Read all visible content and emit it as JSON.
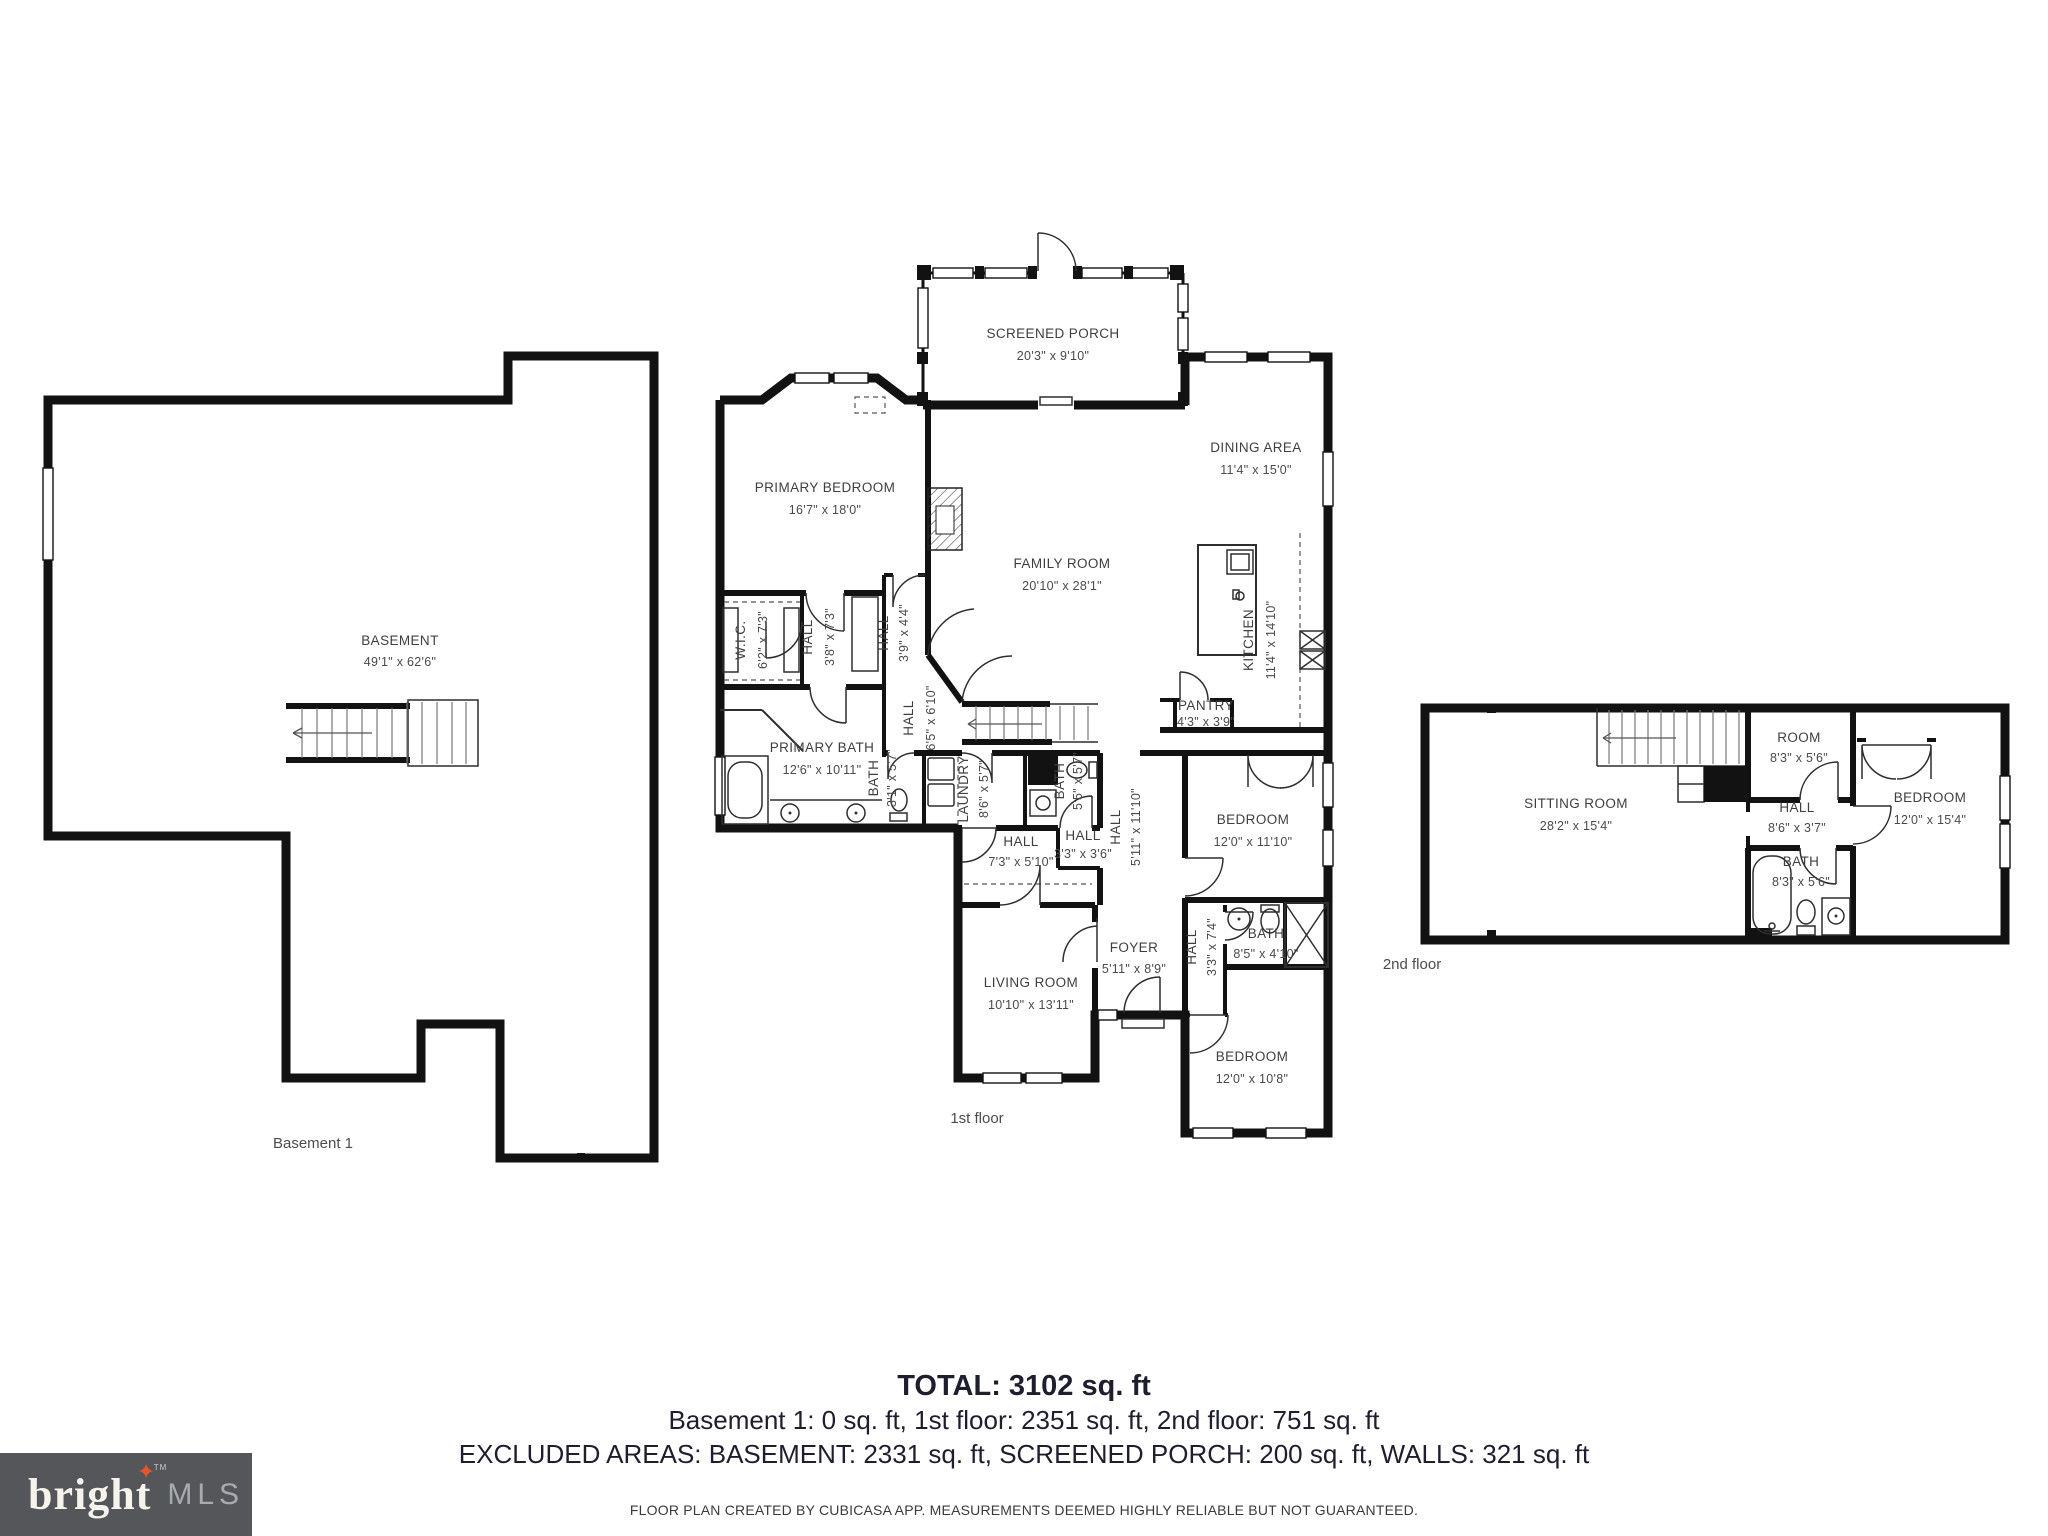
{
  "plans": {
    "basement": {
      "floor_label": "Basement 1",
      "rooms": [
        {
          "name": "BASEMENT",
          "dims": "49'1\" x 62'6\""
        }
      ]
    },
    "first": {
      "floor_label": "1st floor",
      "rooms": [
        {
          "name": "SCREENED PORCH",
          "dims": "20'3\" x 9'10\""
        },
        {
          "name": "PRIMARY BEDROOM",
          "dims": "16'7\" x 18'0\""
        },
        {
          "name": "DINING AREA",
          "dims": "11'4\" x 15'0\""
        },
        {
          "name": "FAMILY ROOM",
          "dims": "20'10\" x 28'1\""
        },
        {
          "name": "KITCHEN",
          "dims": "11'4\" x 14'10\""
        },
        {
          "name": "W.I.C.",
          "dims": "6'2\" x 7'3\""
        },
        {
          "name": "HALL",
          "dims": "3'8\" x 7'3\""
        },
        {
          "name": "HALL",
          "dims": "3'9\" x 4'4\""
        },
        {
          "name": "HALL",
          "dims": "6'5\" x 6'10\""
        },
        {
          "name": "PRIMARY BATH",
          "dims": "12'6\" x 10'11\""
        },
        {
          "name": "BATH",
          "dims": "3'1\" x 5'7\""
        },
        {
          "name": "LAUNDRY",
          "dims": "8'6\" x 5'7\""
        },
        {
          "name": "BATH",
          "dims": "5'5\" x 5'7\""
        },
        {
          "name": "PANTRY",
          "dims": "4'3\" x 3'9\""
        },
        {
          "name": "HALL",
          "dims": "7'3\" x 5'10\""
        },
        {
          "name": "HALL",
          "dims": "3'3\" x 3'6\""
        },
        {
          "name": "HALL",
          "dims": "5'11\" x 11'10\""
        },
        {
          "name": "BEDROOM",
          "dims": "12'0\" x 11'10\""
        },
        {
          "name": "HALL",
          "dims": "3'3\" x 7'4\""
        },
        {
          "name": "BATH",
          "dims": "8'5\" x 4'10\""
        },
        {
          "name": "FOYER",
          "dims": "5'11\" x 8'9\""
        },
        {
          "name": "LIVING ROOM",
          "dims": "10'10\" x 13'11\""
        },
        {
          "name": "BEDROOM",
          "dims": "12'0\" x 10'8\""
        }
      ]
    },
    "second": {
      "floor_label": "2nd floor",
      "rooms": [
        {
          "name": "SITTING ROOM",
          "dims": "28'2\" x 15'4\""
        },
        {
          "name": "ROOM",
          "dims": "8'3\" x 5'6\""
        },
        {
          "name": "HALL",
          "dims": "8'6\" x 3'7\""
        },
        {
          "name": "BATH",
          "dims": "8'3\" x 5'6\""
        },
        {
          "name": "BEDROOM",
          "dims": "12'0\" x 15'4\""
        }
      ]
    }
  },
  "summary": {
    "total": "TOTAL: 3102 sq. ft",
    "by_floor": "Basement 1: 0 sq. ft, 1st floor: 2351 sq. ft, 2nd floor: 751 sq. ft",
    "excluded": "EXCLUDED AREAS: BASEMENT: 2331 sq. ft, SCREENED PORCH: 200 sq. ft, WALLS: 321 sq. ft",
    "disclaimer": "FLOOR PLAN CREATED BY CUBICASA APP. MEASUREMENTS DEEMED HIGHLY RELIABLE BUT NOT GUARANTEED."
  },
  "logo": {
    "brand": "bright",
    "tm": "TM",
    "suffix": "MLS",
    "star": "✦",
    "star_color": "#E4572E",
    "bg_color": "#54565A"
  }
}
